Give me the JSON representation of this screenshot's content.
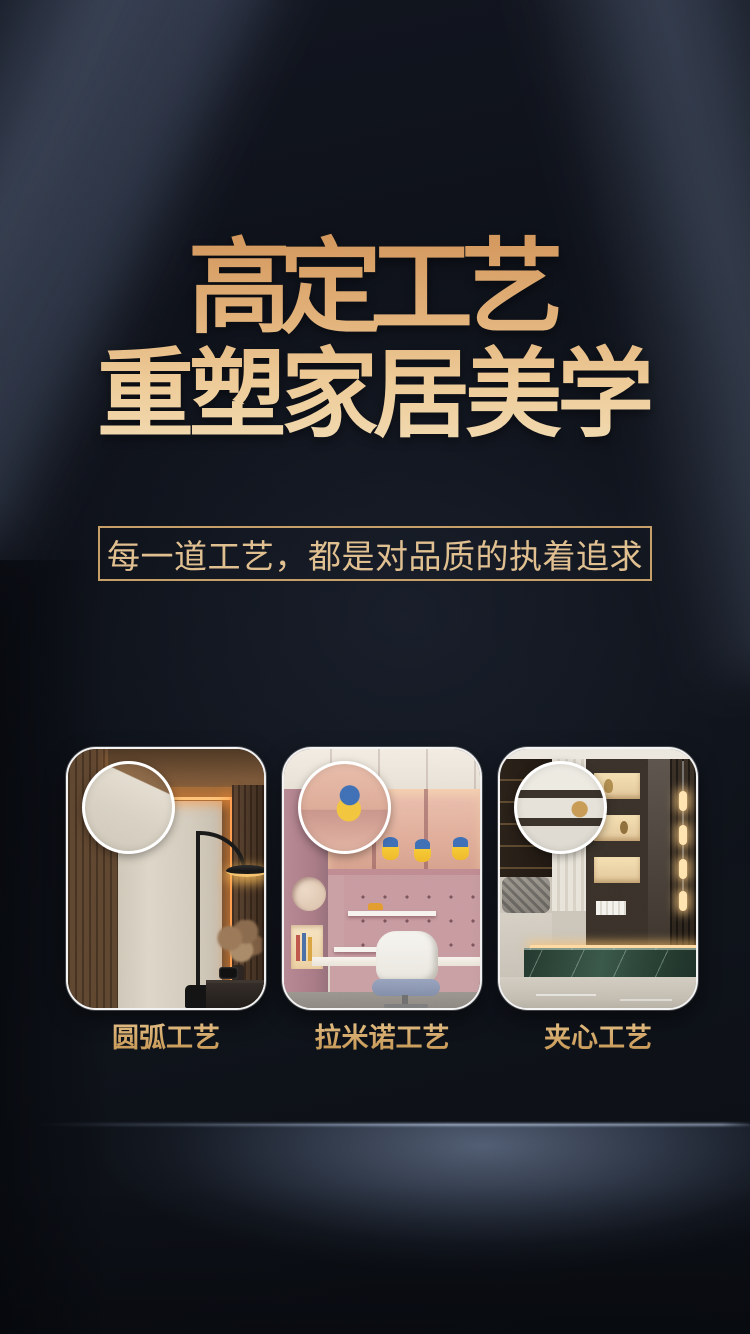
{
  "hero": {
    "title_line1": "高定工艺",
    "title_line2": "重塑家居美学",
    "tagline": "每一道工艺，都是对品质的执着追求"
  },
  "craft_cards": [
    {
      "label": "圆弧工艺",
      "scene": "bedroom-wardrobe-arc-corner",
      "magnifier": "magnifier-circle"
    },
    {
      "label": "拉米诺工艺",
      "scene": "kids-study-room-shelving",
      "magnifier": "magnifier-circle"
    },
    {
      "label": "夹心工艺",
      "scene": "showroom-display-wall",
      "magnifier": "magnifier-circle"
    }
  ],
  "colors": {
    "background_dark": "#0c1017",
    "title_gold_dark": "#d2955b",
    "title_gold_light": "#f1dab0",
    "tagline_gold": "#e0bf8e",
    "box_border_gold": "#c59e66",
    "label_gold": "#d3a768",
    "floor_glow_blue": "#8fa3c5",
    "card_border_white": "#f3f3f3"
  }
}
